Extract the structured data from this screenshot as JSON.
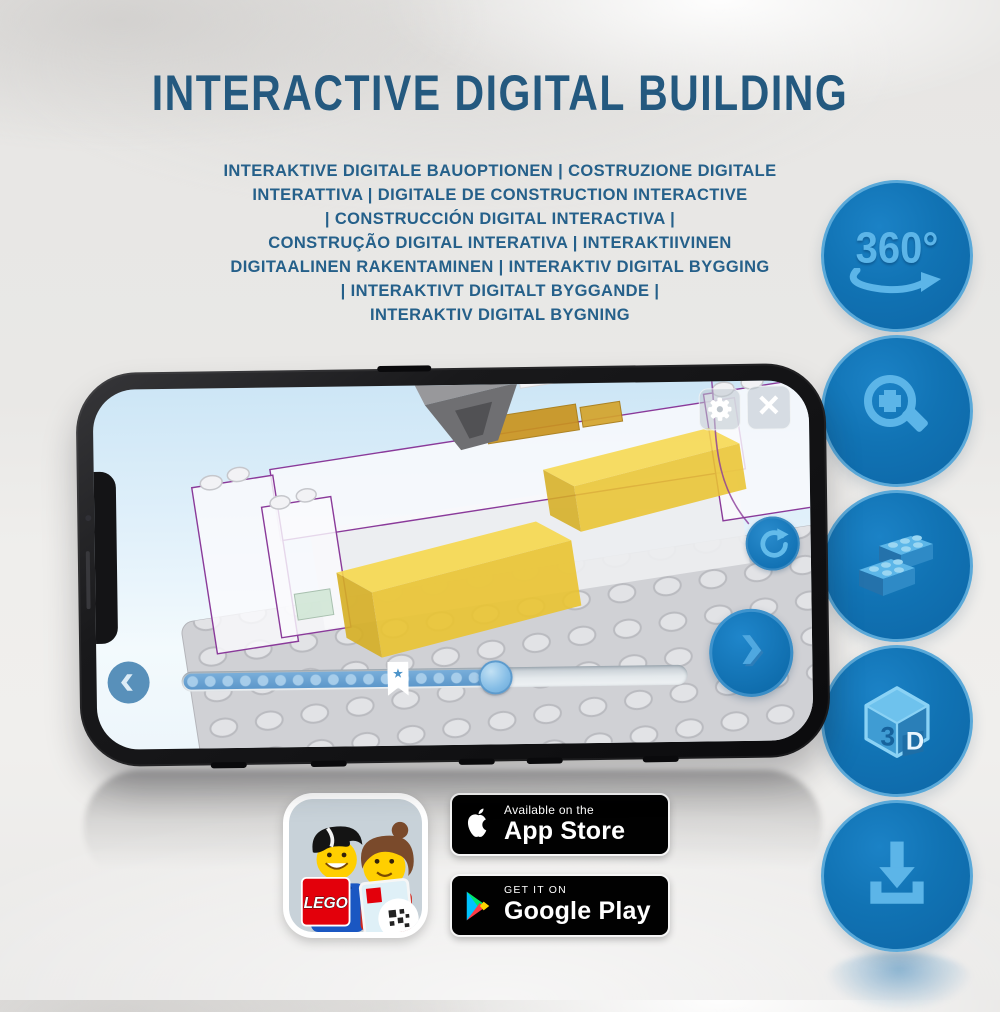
{
  "title": "INTERACTIVE DIGITAL BUILDING",
  "subtitle_lines": [
    "INTERAKTIVE DIGITALE BAUOPTIONEN | COSTRUZIONE DIGITALE",
    "INTERATTIVA | DIGITALE DE CONSTRUCTION INTERACTIVE",
    "| CONSTRUCCIÓN DIGITAL INTERACTIVA |",
    "CONSTRUÇÃO DIGITAL INTERATIVA | INTERAKTIIVINEN",
    "DIGITAALINEN RAKENTAMINEN | INTERAKTIV DIGITAL BYGGING",
    "| INTERAKTIVT DIGITALT BYGGANDE |",
    "INTERAKTIV DIGITAL BYGNING"
  ],
  "features": [
    {
      "icon": "rotate-360-icon",
      "label": "360°"
    },
    {
      "icon": "zoom-in-icon"
    },
    {
      "icon": "lego-bricks-icon"
    },
    {
      "icon": "3d-cube-icon",
      "cube_left": "3",
      "cube_right": "D"
    },
    {
      "icon": "download-icon"
    }
  ],
  "phone": {
    "screen_ui": {
      "close_glyph": "×",
      "bookmark_star": "★",
      "progress_percent_filled": 62,
      "bookmark_at_percent": 43
    }
  },
  "store": {
    "app_icon_logo_text": "LEGO",
    "app_store_badge": {
      "line1": "Available on the",
      "line2": "App Store"
    },
    "google_play_badge": {
      "line1": "GET IT ON",
      "line2": "Google Play"
    }
  },
  "colors": {
    "heading_blue": "#24597f",
    "feature_circle_blue": "#0f6dad",
    "feature_glyph_blue": "#55b1e5",
    "ui_accent_blue": "#1b7cc2",
    "progress_fill_blue": "#5c97ca",
    "lego_red": "#e3000b",
    "brick_yellow": "#f2d43c",
    "badge_black": "#010101",
    "screen_sky": "#cde6f6"
  }
}
